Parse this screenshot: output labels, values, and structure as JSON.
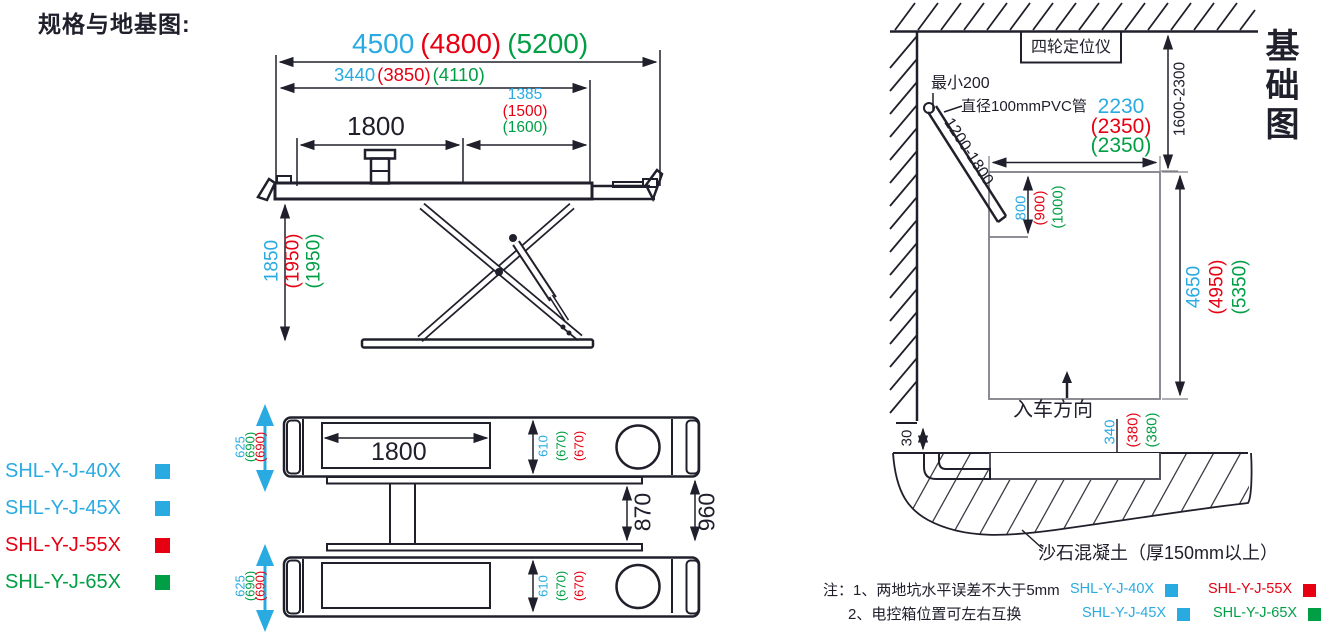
{
  "title": "规格与地基图:",
  "colors": {
    "blue": "#29ABE2",
    "red": "#E60012",
    "green": "#009E45",
    "line": "#20202c"
  },
  "side_view": {
    "dim_total_length": {
      "blue": "4500",
      "red": "(4800)",
      "green": "(5200)"
    },
    "dim_platform_length": {
      "blue": "3440",
      "red": "(3850)",
      "green": "(4110)"
    },
    "dim_rear_section": {
      "blue": "1385",
      "red": "(1500)",
      "green": "(1600)"
    },
    "dim_wheelbase": "1800",
    "dim_lift_height": {
      "blue": "1850",
      "red": "(1950)",
      "green": "(1950)"
    }
  },
  "top_view": {
    "dim_recess_length": "1800",
    "dim_platform_overall_width": {
      "blue": "625",
      "green": "(690)",
      "red": "(690)"
    },
    "dim_platform_width": {
      "blue": "610",
      "green": "(670)",
      "red": "(670)"
    },
    "dim_inner_gap": "870",
    "dim_platform_gap": "960"
  },
  "models": [
    {
      "name": "SHL-Y-J-40X",
      "color": "#29ABE2"
    },
    {
      "name": "SHL-Y-J-45X",
      "color": "#29ABE2"
    },
    {
      "name": "SHL-Y-J-55X",
      "color": "#E60012"
    },
    {
      "name": "SHL-Y-J-65X",
      "color": "#009E45"
    }
  ],
  "foundation": {
    "vertical_title": "基础图",
    "aligner_box_label": "四轮定位仪",
    "min_gap_label": "最小200",
    "pvc_pipe_label": "直径100mmPVC管",
    "pipe_length_range": "1200-1800",
    "dim_pit_width": {
      "blue": "2230",
      "red": "(2350)",
      "green": "(2350)"
    },
    "dim_wall_distance": "1600-2300",
    "dim_recess_depth": {
      "blue": "800",
      "red": "(900)",
      "green": "(1000)"
    },
    "dim_pit_length": {
      "blue": "4650",
      "red": "(4950)",
      "green": "(5350)"
    },
    "entry_direction_label": "入车方向",
    "dim_pit_depth": {
      "blue": "340",
      "red": "(380)",
      "green": "(380)"
    },
    "dim_edge_step": "30",
    "concrete_label": "沙石混凝土（厚150mm以上）",
    "notes": [
      "注：1、两地坑水平误差不大于5mm",
      "2、电控箱位置可左右互换"
    ],
    "legend": [
      {
        "name": "SHL-Y-J-40X",
        "color": "#29ABE2"
      },
      {
        "name": "SHL-Y-J-55X",
        "color": "#E60012"
      },
      {
        "name": "SHL-Y-J-45X",
        "color": "#29ABE2"
      },
      {
        "name": "SHL-Y-J-65X",
        "color": "#009E45"
      }
    ]
  }
}
